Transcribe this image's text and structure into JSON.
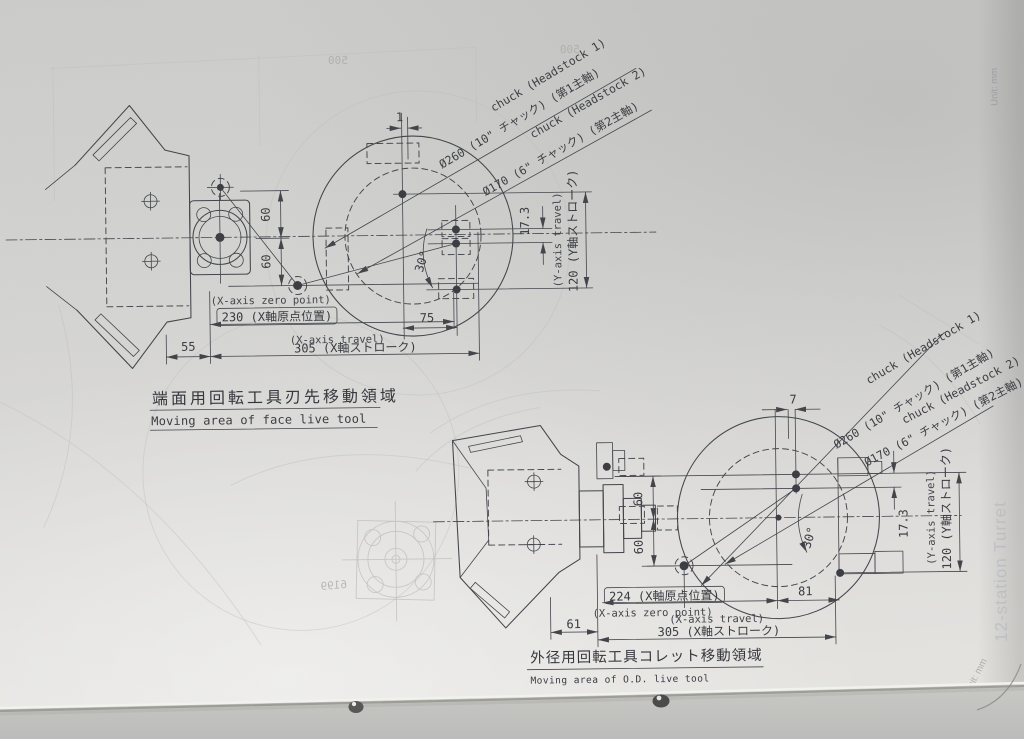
{
  "d1": {
    "chuck1_line1": "chuck (Headstock 1)",
    "chuck1_line2": "Ø260 (10\" チャック) (第1主軸)",
    "chuck2_line1": "chuck (Headstock 2)",
    "chuck2_line2": "Ø170 (6\" チャック) (第2主軸)",
    "dim_1": "1",
    "dim_60_upper": "60",
    "dim_60_lower": "60",
    "dim_75": "75",
    "dim_30": "30°",
    "dim_17_3": "17.3",
    "y_travel_en": "(Y-axis travel)",
    "y_travel_ja": "120 (Y軸ストローク)",
    "x_zero_en": "(X-axis zero point)",
    "x_zero_ja": "230 (X軸原点位置)",
    "dim_55": "55",
    "x_travel_en": "(X-axis travel)",
    "x_travel_ja": "305 (X軸ストローク)",
    "title_ja": "端面用回転工具刃先移動領域",
    "title_en": "Moving area of face live tool"
  },
  "d2": {
    "chuck1_line1": "chuck (Headstock 1)",
    "chuck1_line2": "Ø260 (10\" チャック) (第1主軸)",
    "chuck2_line1": "chuck (Headstock 2)",
    "chuck2_line2": "Ø170 (6\" チャック) (第2主軸)",
    "dim_7": "7",
    "dim_60_upper": "60",
    "dim_60_lower": "60",
    "dim_30": "30°",
    "dim_17_3": "17.3",
    "y_travel_en": "(Y-axis travel)",
    "y_travel_ja": "120 (Y軸ストローク)",
    "x_zero_ja": "224 (X軸原点位置)",
    "x_zero_en": "(X-axis zero point)",
    "dim_81": "81",
    "dim_61": "61",
    "x_travel_en": "(X-axis travel)",
    "x_travel_ja": "305 (X軸ストローク)",
    "title_ja": "外径用回転工具コレット移動領域",
    "title_en": "Moving area of O.D. live tool"
  },
  "ghost": {
    "dim_500_a": "500",
    "dim_500_b": "500",
    "num_bleed": "6199",
    "side_tab": "12-station Turret",
    "side_unit": "Unit: mm",
    "top_unit": "Unit: mm"
  }
}
